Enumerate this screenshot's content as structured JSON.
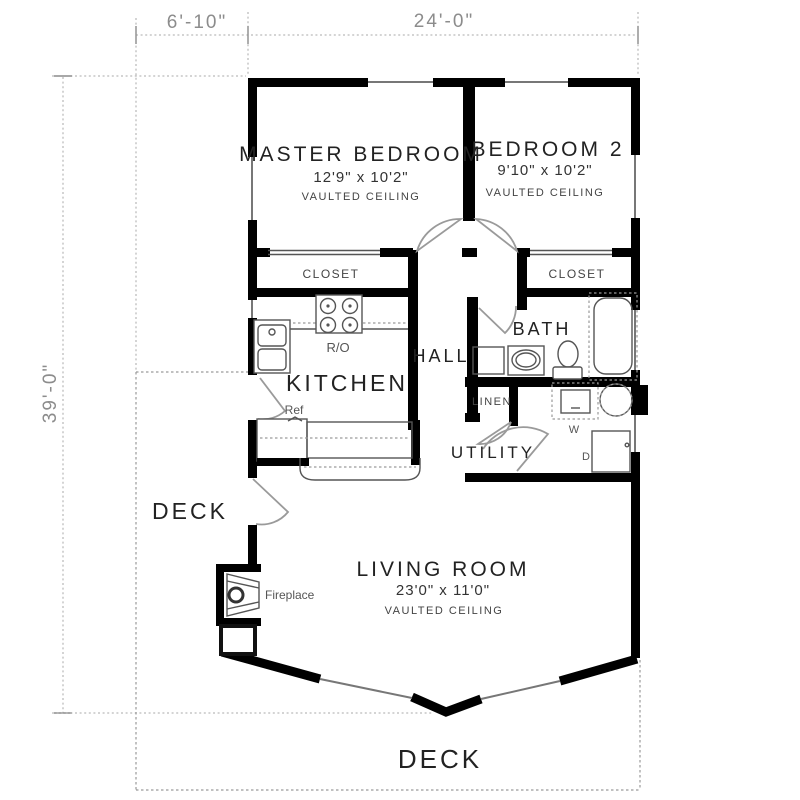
{
  "dimensions": {
    "top_left": "6'-10\"",
    "top_right": "24'-0\"",
    "left": "39'-0\""
  },
  "rooms": {
    "master_bedroom": {
      "name": "MASTER BEDROOM",
      "size": "12'9\" x 10'2\"",
      "note": "VAULTED CEILING"
    },
    "bedroom2": {
      "name": "BEDROOM 2",
      "size": "9'10\" x 10'2\"",
      "note": "VAULTED CEILING"
    },
    "living_room": {
      "name": "LIVING ROOM",
      "size": "23'0\" x 11'0\"",
      "note": "VAULTED CEILING"
    },
    "kitchen": {
      "name": "KITCHEN"
    },
    "hall": {
      "name": "HALL"
    },
    "bath": {
      "name": "BATH"
    },
    "utility": {
      "name": "UTILITY"
    },
    "linen": {
      "name": "LINEN"
    },
    "closet_master": {
      "name": "CLOSET"
    },
    "closet_bedroom2": {
      "name": "CLOSET"
    },
    "deck_side": {
      "name": "DECK"
    },
    "deck_bottom": {
      "name": "DECK"
    }
  },
  "labels": {
    "range_oven": "R/O",
    "refrigerator": "Ref",
    "fireplace": "Fireplace",
    "washer": "W",
    "dryer": "D"
  },
  "colors": {
    "wall": "#000000",
    "fixture_line": "#555555",
    "door_line": "#9a9a9a",
    "dimension_text": "#8c8c8c",
    "label_text": "#222222",
    "background": "#ffffff"
  }
}
